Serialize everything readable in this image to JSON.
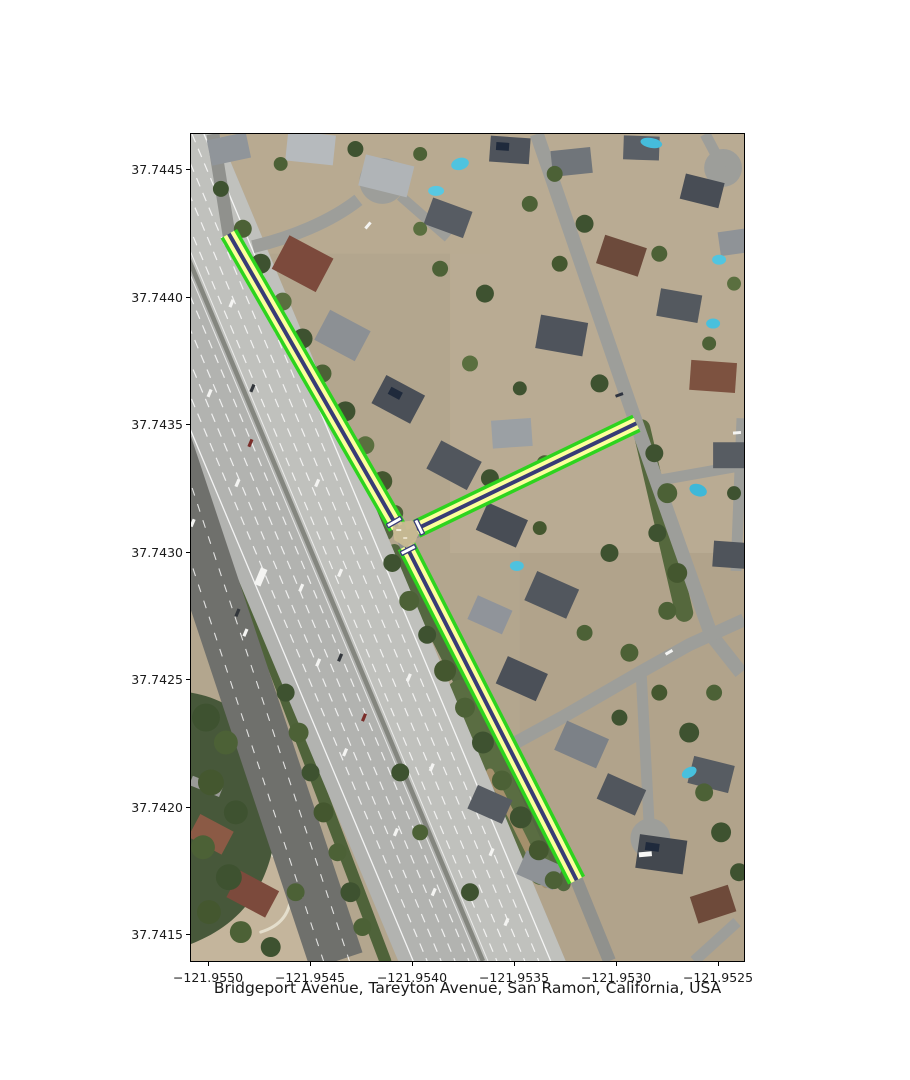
{
  "figure": {
    "width_px": 910,
    "height_px": 1080,
    "background": "#ffffff"
  },
  "plot": {
    "xlabel": "Bridgeport Avenue, Tareyton Avenue, San Ramon, California, USA"
  },
  "axes": {
    "y_ticks": [
      "37.7445",
      "37.7440",
      "37.7435",
      "37.7430",
      "37.7425",
      "37.7420",
      "37.7415"
    ],
    "x_ticks": [
      "−121.9550",
      "−121.9545",
      "−121.9540",
      "−121.9535",
      "−121.9530",
      "−121.9525"
    ]
  },
  "map": {
    "kind": "aerial-imagery-with-highlighted-route",
    "highlighted_roads": [
      "Bridgeport Avenue",
      "Tareyton Avenue"
    ],
    "location": "San Ramon, California, USA",
    "route_style": {
      "casing_color": "#2dd41e",
      "fill_color": "#fdff9c",
      "centerline_color": "#383c76",
      "crossing_marker_color": "#ffffff"
    }
  }
}
